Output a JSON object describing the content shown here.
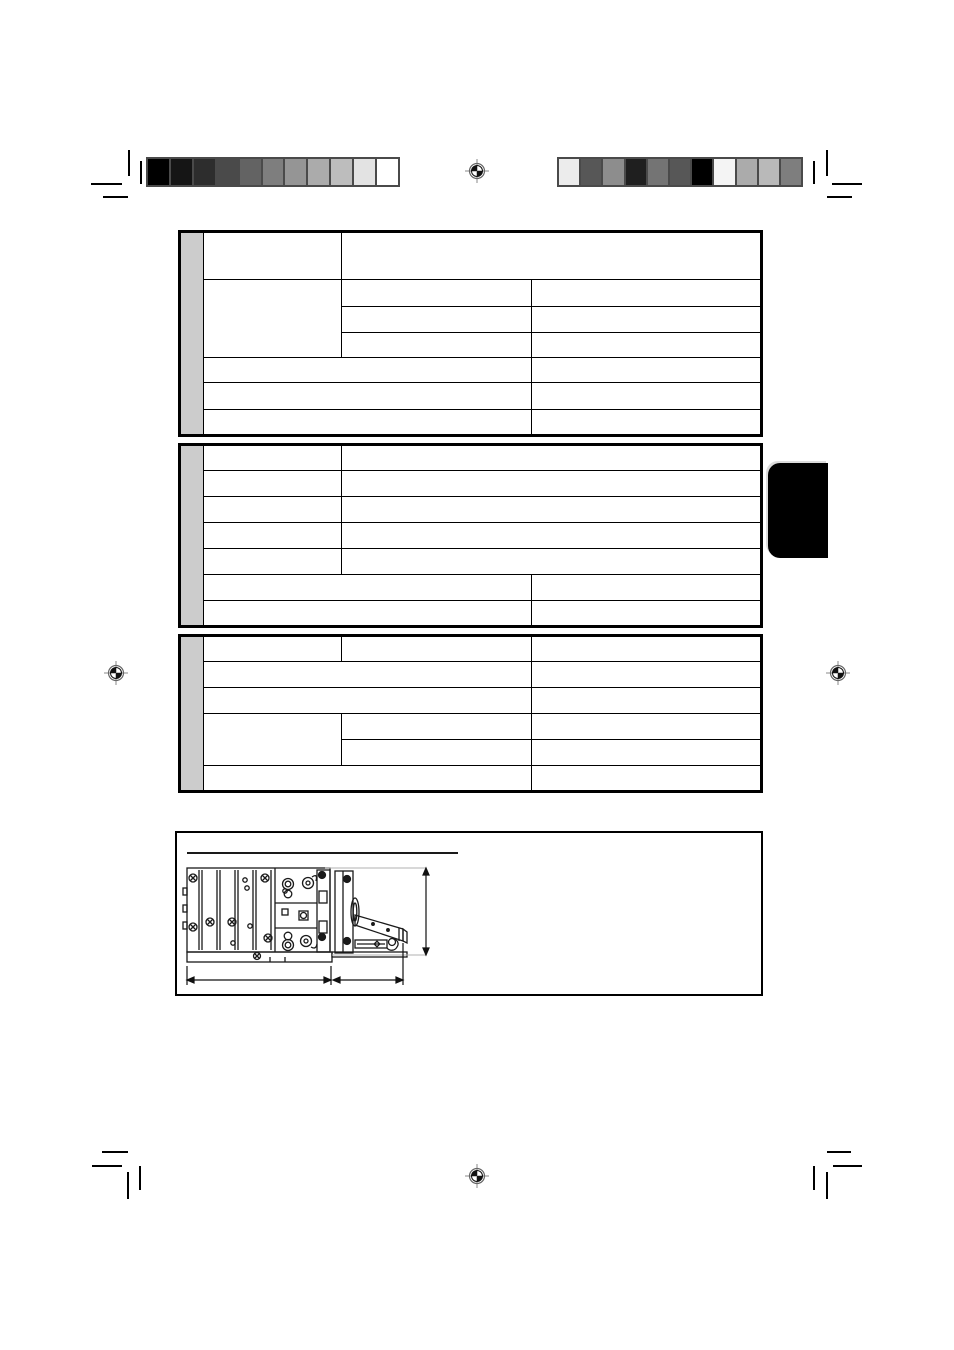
{
  "document": {
    "kind": "printed-manual-specifications-page",
    "background": "#ffffff",
    "visible_text": ""
  },
  "print_marks": {
    "left_color_bar": {
      "border_color": "#4a4a4a",
      "swatches": [
        "#000000",
        "#151515",
        "#2d2d2d",
        "#4a4a4a",
        "#636363",
        "#7e7e7e",
        "#959595",
        "#ababab",
        "#bdbdbd",
        "#e3e3e3",
        "#ffffff"
      ]
    },
    "right_color_bar": {
      "border_color": "#4a4a4a",
      "swatches": [
        "#ececec",
        "#575757",
        "#8d8d8d",
        "#1f1f1f",
        "#747474",
        "#575757",
        "#000000",
        "#f4f4f4",
        "#ababab",
        "#b9b9b9",
        "#7e7e7e"
      ]
    },
    "registration_marks": {
      "count": 4,
      "positions": [
        "top-center",
        "left-middle",
        "right-middle",
        "bottom-center"
      ],
      "ring_color": "#666666",
      "fill_color": "#111111"
    },
    "corner_crop_marks": {
      "count": 16,
      "color": "#000000"
    }
  },
  "section_tab": {
    "color": "#000000",
    "label": ""
  },
  "spec_tables": {
    "column_widths": [
      24,
      138,
      190,
      230
    ],
    "sidebar_color": "#cccccc",
    "border_color": "#000000",
    "tables": [
      {
        "name": "spec-table-1",
        "row_heights": [
          48,
          27,
          26,
          25,
          25,
          27,
          26
        ],
        "rows": [
          [
            {
              "cs": 1,
              "rs": 1,
              "text": ""
            },
            {
              "cs": 2,
              "rs": 1,
              "text": ""
            }
          ],
          [
            {
              "cs": 1,
              "rs": 3,
              "text": ""
            },
            {
              "cs": 1,
              "rs": 1,
              "text": ""
            },
            {
              "cs": 1,
              "rs": 1,
              "text": ""
            }
          ],
          [
            {
              "cs": 1,
              "rs": 1,
              "text": ""
            },
            {
              "cs": 1,
              "rs": 1,
              "text": ""
            }
          ],
          [
            {
              "cs": 1,
              "rs": 1,
              "text": ""
            },
            {
              "cs": 1,
              "rs": 1,
              "text": ""
            }
          ],
          [
            {
              "cs": 2,
              "rs": 1,
              "text": ""
            },
            {
              "cs": 1,
              "rs": 1,
              "text": ""
            }
          ],
          [
            {
              "cs": 2,
              "rs": 1,
              "text": ""
            },
            {
              "cs": 1,
              "rs": 1,
              "text": ""
            }
          ],
          [
            {
              "cs": 2,
              "rs": 1,
              "text": ""
            },
            {
              "cs": 1,
              "rs": 1,
              "text": ""
            }
          ]
        ]
      },
      {
        "name": "spec-table-2",
        "row_heights": [
          26,
          26,
          26,
          26,
          26,
          26,
          26
        ],
        "rows": [
          [
            {
              "cs": 1,
              "rs": 1,
              "text": ""
            },
            {
              "cs": 2,
              "rs": 1,
              "text": ""
            }
          ],
          [
            {
              "cs": 1,
              "rs": 1,
              "text": ""
            },
            {
              "cs": 2,
              "rs": 1,
              "text": ""
            }
          ],
          [
            {
              "cs": 1,
              "rs": 1,
              "text": ""
            },
            {
              "cs": 2,
              "rs": 1,
              "text": ""
            }
          ],
          [
            {
              "cs": 1,
              "rs": 1,
              "text": ""
            },
            {
              "cs": 2,
              "rs": 1,
              "text": ""
            }
          ],
          [
            {
              "cs": 1,
              "rs": 1,
              "text": ""
            },
            {
              "cs": 2,
              "rs": 1,
              "text": ""
            }
          ],
          [
            {
              "cs": 2,
              "rs": 1,
              "text": ""
            },
            {
              "cs": 1,
              "rs": 1,
              "text": ""
            }
          ],
          [
            {
              "cs": 2,
              "rs": 1,
              "text": ""
            },
            {
              "cs": 1,
              "rs": 1,
              "text": ""
            }
          ]
        ]
      },
      {
        "name": "spec-table-3",
        "row_heights": [
          26,
          26,
          26,
          26,
          26,
          26
        ],
        "rows": [
          [
            {
              "cs": 1,
              "rs": 1,
              "text": ""
            },
            {
              "cs": 1,
              "rs": 1,
              "text": ""
            },
            {
              "cs": 1,
              "rs": 1,
              "text": ""
            }
          ],
          [
            {
              "cs": 2,
              "rs": 1,
              "text": ""
            },
            {
              "cs": 1,
              "rs": 1,
              "text": ""
            }
          ],
          [
            {
              "cs": 2,
              "rs": 1,
              "text": ""
            },
            {
              "cs": 1,
              "rs": 1,
              "text": ""
            }
          ],
          [
            {
              "cs": 1,
              "rs": 2,
              "text": ""
            },
            {
              "cs": 1,
              "rs": 1,
              "text": ""
            },
            {
              "cs": 1,
              "rs": 1,
              "text": ""
            }
          ],
          [
            {
              "cs": 1,
              "rs": 1,
              "text": ""
            },
            {
              "cs": 1,
              "rs": 1,
              "text": ""
            }
          ],
          [
            {
              "cs": 2,
              "rs": 1,
              "text": ""
            },
            {
              "cs": 1,
              "rs": 1,
              "text": ""
            }
          ]
        ]
      }
    ]
  },
  "dimension_box": {
    "title_rule": true,
    "drawing": "head-unit-side-view-with-extended-monitor-panel",
    "line_color": "#1a1a1a",
    "extension_line_color": "#b0b0b0"
  }
}
